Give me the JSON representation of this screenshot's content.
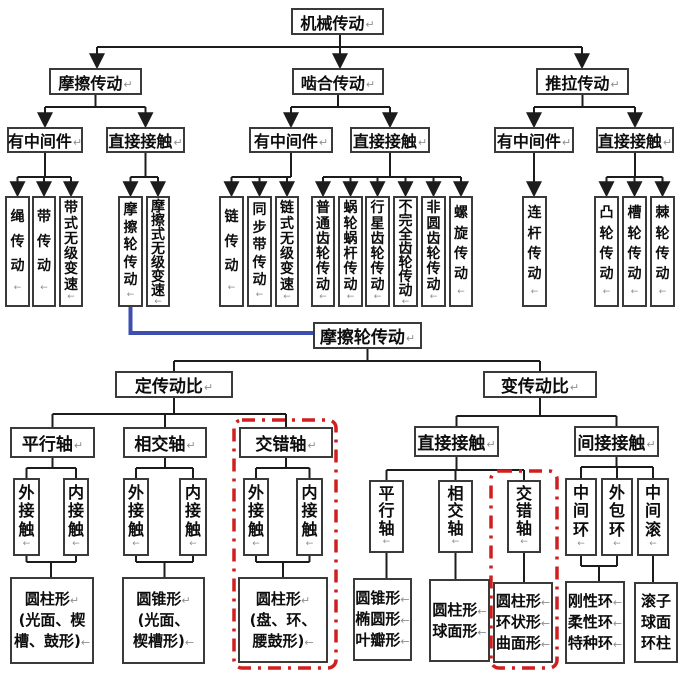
{
  "nodes": {
    "jixie": {
      "label": "机械传动",
      "mark": "↵"
    },
    "moca": {
      "label": "摩擦传动",
      "mark": "↵"
    },
    "niehe": {
      "label": "啮合传动",
      "mark": "↵"
    },
    "tuila": {
      "label": "推拉传动",
      "mark": "↵"
    },
    "moca_mid": {
      "label": "有中间件",
      "mark": "↵"
    },
    "moca_dir": {
      "label": "直接接触",
      "mark": "↵"
    },
    "niehe_mid": {
      "label": "有中间件",
      "mark": "↵"
    },
    "niehe_dir": {
      "label": "直接接触",
      "mark": "↵"
    },
    "tuila_mid": {
      "label": "有中间件",
      "mark": "↵"
    },
    "tuila_dir": {
      "label": "直接接触",
      "mark": "↵"
    },
    "sheng": {
      "label": "绳传动",
      "mark": "←"
    },
    "dai": {
      "label": "带传动",
      "mark": "←"
    },
    "daishi": {
      "label": "带式无级变速",
      "mark": "←"
    },
    "mocalun": {
      "label": "摩擦轮传动",
      "mark": "←"
    },
    "mocashi": {
      "label": "摩擦式无级变速",
      "mark": "←"
    },
    "lian": {
      "label": "链传动",
      "mark": "←"
    },
    "tongbu": {
      "label": "同步带传动",
      "mark": "←"
    },
    "lianshi": {
      "label": "链式无级变速",
      "mark": "←"
    },
    "putong": {
      "label": "普通齿轮传动",
      "mark": "←"
    },
    "wolun": {
      "label": "蜗轮蜗杆传动",
      "mark": "←"
    },
    "xingxing": {
      "label": "行星齿轮传动",
      "mark": "←"
    },
    "buwanquan": {
      "label": "不完全齿轮传动",
      "mark": "←"
    },
    "feiyuan": {
      "label": "非圆齿轮传动",
      "mark": "←"
    },
    "luoxuan": {
      "label": "螺旋传动",
      "mark": "←"
    },
    "liangan": {
      "label": "连杆传动",
      "mark": "←"
    },
    "tulun": {
      "label": "凸轮传动",
      "mark": "←"
    },
    "caolun": {
      "label": "槽轮传动",
      "mark": "←"
    },
    "jilun": {
      "label": "棘轮传动",
      "mark": "←"
    },
    "mocalun2": {
      "label": "摩擦轮传动",
      "mark": "↵"
    },
    "ding": {
      "label": "定传动比",
      "mark": "↵"
    },
    "bian": {
      "label": "变传动比",
      "mark": "↵"
    },
    "pingxing": {
      "label": "平行轴",
      "mark": "↵"
    },
    "xiangjiao": {
      "label": "相交轴",
      "mark": "↵"
    },
    "jiaocuo": {
      "label": "交错轴",
      "mark": "↵"
    },
    "wai": {
      "label": "外接触",
      "mark": "←"
    },
    "nei": {
      "label": "内接触",
      "mark": "←"
    },
    "zhijie2": {
      "label": "直接接触",
      "mark": "↵"
    },
    "jianjie": {
      "label": "间接接触",
      "mark": "↵"
    },
    "pingxing2": {
      "label": "平行轴",
      "mark": "←"
    },
    "xiangjiao2": {
      "label": "相交轴",
      "mark": "←"
    },
    "jiaocuo2": {
      "label": "交错轴",
      "mark": "←"
    },
    "zjh": {
      "label": "中间环",
      "mark": "←"
    },
    "wbh": {
      "label": "外包环",
      "mark": "←"
    },
    "zjg": {
      "label": "中间滚",
      "mark": "←"
    },
    "leafA": {
      "lines": [
        {
          "t": "圆柱形",
          "m": "↵"
        },
        {
          "t": "(光面、楔",
          "m": ""
        },
        {
          "t": "槽、鼓形)",
          "m": "←"
        }
      ]
    },
    "leafB": {
      "lines": [
        {
          "t": "圆锥形",
          "m": "↵"
        },
        {
          "t": "(光面、",
          "m": ""
        },
        {
          "t": "楔槽形)",
          "m": "←"
        }
      ]
    },
    "leafC": {
      "lines": [
        {
          "t": "圆柱形",
          "m": "↵"
        },
        {
          "t": "(盘、环、",
          "m": ""
        },
        {
          "t": "腰鼓形)",
          "m": "←"
        }
      ]
    },
    "leafD": {
      "lines": [
        {
          "t": "圆锥形",
          "m": "←"
        },
        {
          "t": "椭圆形",
          "m": "←"
        },
        {
          "t": "叶瓣形",
          "m": "←"
        }
      ]
    },
    "leafE": {
      "lines": [
        {
          "t": "圆柱形",
          "m": "←"
        },
        {
          "t": "球面形",
          "m": "←"
        }
      ]
    },
    "leafF": {
      "lines": [
        {
          "t": "圆柱形",
          "m": "←"
        },
        {
          "t": "环状形",
          "m": "←"
        },
        {
          "t": "曲面形",
          "m": "←"
        }
      ]
    },
    "leafG": {
      "lines": [
        {
          "t": "刚性环",
          "m": "←"
        },
        {
          "t": "柔性环",
          "m": "←"
        },
        {
          "t": "特种环",
          "m": "←"
        }
      ]
    },
    "leafH": {
      "lines": [
        {
          "t": "滚子",
          "m": ""
        },
        {
          "t": "球面",
          "m": ""
        },
        {
          "t": "环柱",
          "m": ""
        }
      ]
    }
  },
  "colors": {
    "line": "#1c1c1c",
    "blue_link": "#3d4fae",
    "highlight_red": "#cf1f1f",
    "squiggle_red": "#d03232"
  }
}
